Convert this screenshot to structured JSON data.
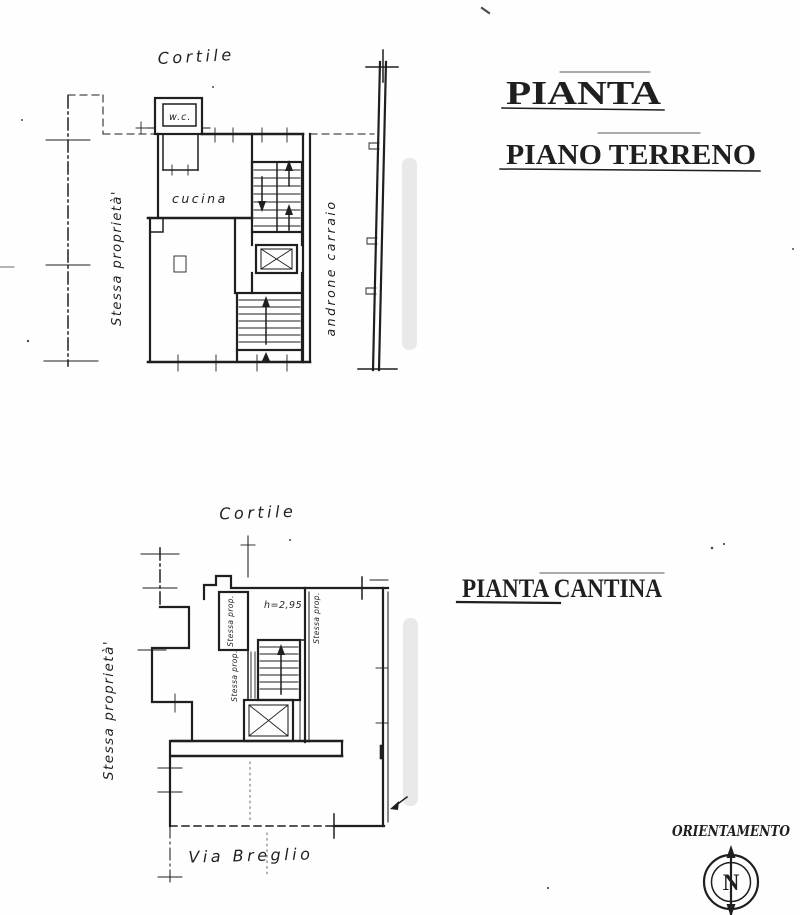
{
  "document": {
    "paper_color": "#fefefe",
    "ink_color": "#1f1f1f",
    "scan_band_color": "#e9e9e9"
  },
  "ground_floor": {
    "title_line1": "PIANTA",
    "title_line2": "PIANO TERRENO",
    "courtyard_label": "Cortile",
    "same_property_label": "Stessa proprietà'",
    "kitchen_label": "cucina",
    "wc_label": "w.c.",
    "carriage_entrance_label": "androne carraio"
  },
  "basement": {
    "title": "PIANTA CANTINA",
    "courtyard_label": "Cortile",
    "same_property_label": "Stessa proprietà'",
    "same_property_short_1": "Stessa prop.",
    "same_property_short_2": "Stessa prop.",
    "same_property_short_3": "Stessa prop.",
    "ceiling_height_label": "h=2,95",
    "street_label": "Via Breglio"
  },
  "orientation": {
    "label": "ORIENTAMENTO",
    "north_letter": "N"
  }
}
